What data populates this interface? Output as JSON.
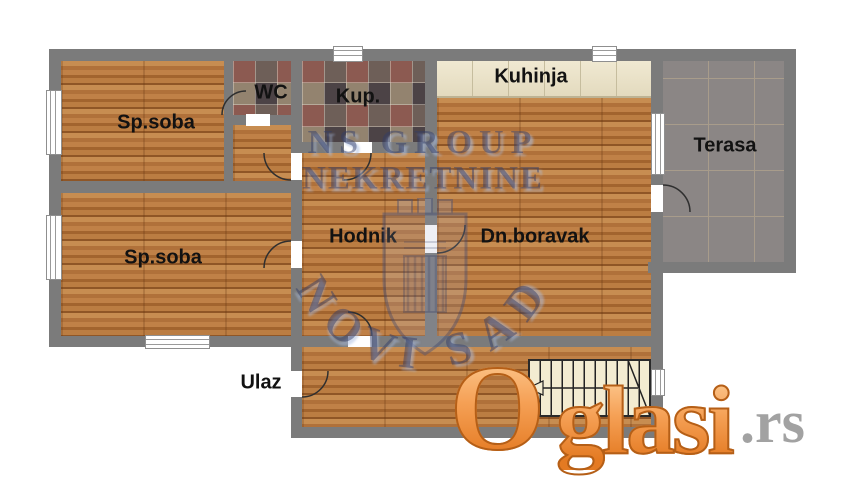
{
  "rooms": {
    "spsoba1": "Sp.soba",
    "wc": "WC",
    "kup": "Kup.",
    "kuhinja": "Kuhinja",
    "terasa": "Terasa",
    "spsoba2": "Sp.soba",
    "hodnik": "Hodnik",
    "dnboravak": "Dn.boravak",
    "ulaz": "Ulaz"
  },
  "watermark": {
    "line1": "NS GROUP",
    "line2": "NEKRETNINE",
    "arc_letters": [
      "N",
      "O",
      "V",
      "I",
      "S",
      "A",
      "D"
    ],
    "color": "#324169"
  },
  "logo": {
    "part1": "O",
    "part2": "glasi",
    "part3": ".rs",
    "orange": "#ef8c33",
    "gray": "#a2a2a2"
  },
  "colors": {
    "wall": "#7b7b7b",
    "wood_floor": "#b67a3e",
    "bath_tile": "#6b5c57",
    "kitchen_tile": "#eae2c8",
    "terrace_tile": "#8b8685",
    "stairs": "#f3ecd1",
    "background": "#ffffff"
  }
}
